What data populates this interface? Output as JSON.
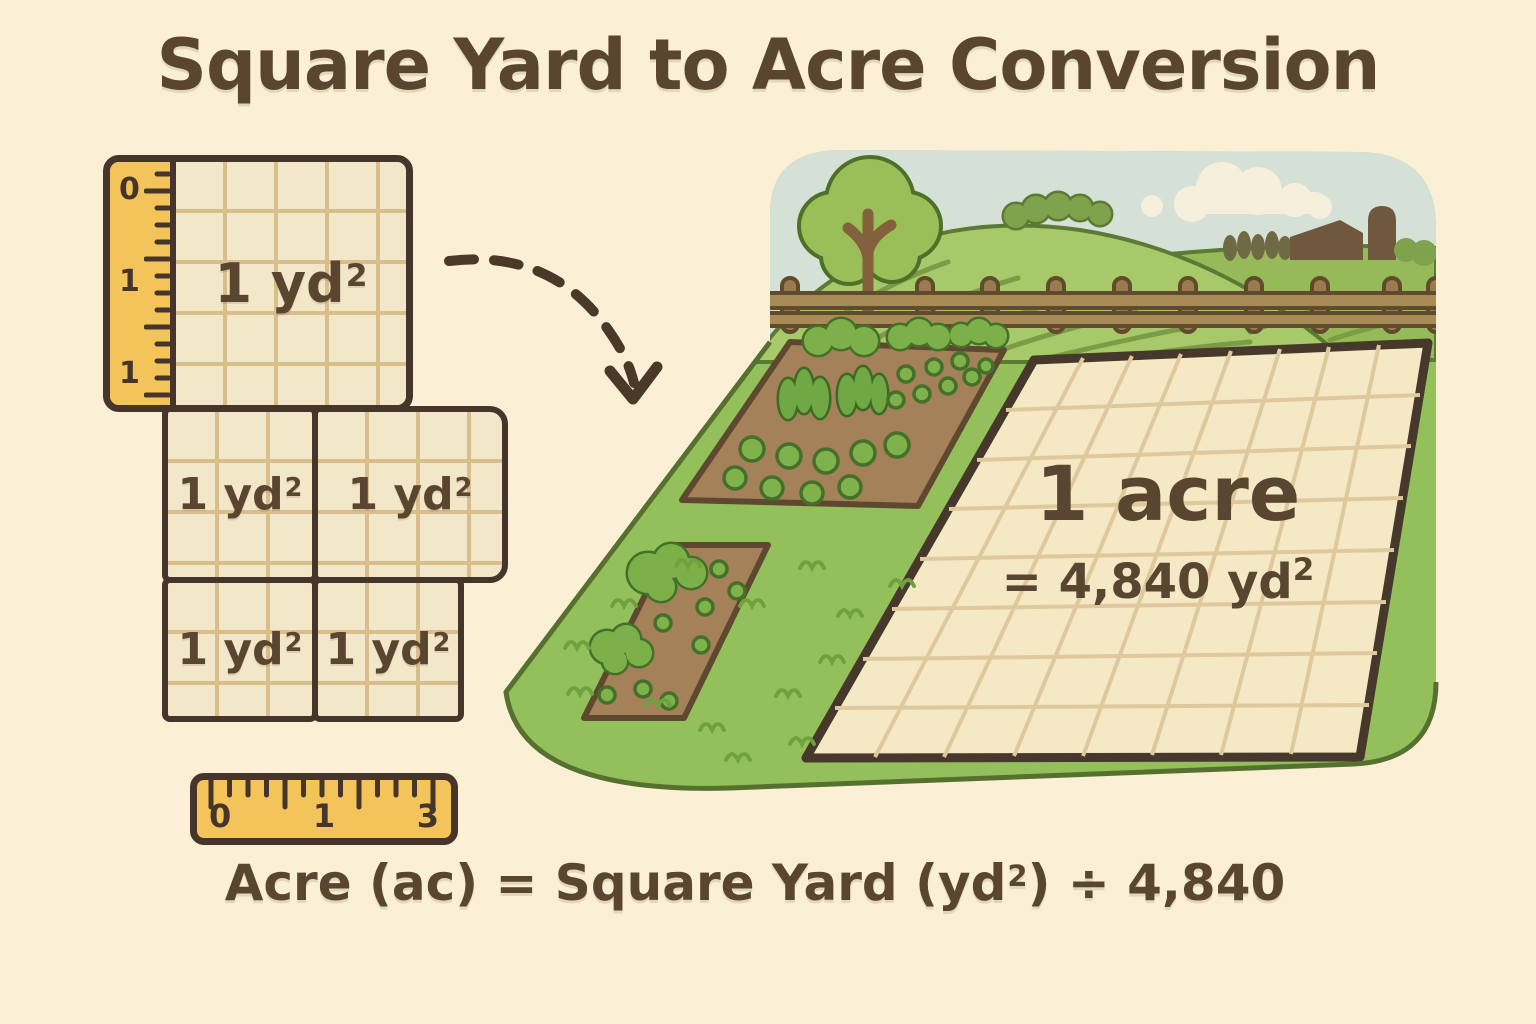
{
  "title": "Square Yard to Acre Conversion",
  "left_diagram": {
    "vertical_ruler": {
      "tick_labels": [
        "0",
        "1",
        "1"
      ]
    },
    "unit_squares": [
      {
        "base": "1 yd",
        "sup": "2"
      },
      {
        "base": "1 yd",
        "sup": "2"
      },
      {
        "base": "1 yd",
        "sup": "2"
      },
      {
        "base": "1 yd",
        "sup": "2"
      },
      {
        "base": "1 yd",
        "sup": "2"
      }
    ]
  },
  "farm_scene": {
    "acre_parcel": {
      "label": "1 acre",
      "equation_base": "= 4,840 yd",
      "equation_sup": "2"
    }
  },
  "horizontal_ruler": {
    "tick_labels": [
      "0",
      "1",
      "3"
    ]
  },
  "formula": {
    "before_sup": "Acre (ac) = Square Yard (yd",
    "sup": "2",
    "after_sup": ") ÷ 4,840"
  },
  "colors": {
    "background": "#FBF0D5",
    "ink_brown": "#594530",
    "outline_brown": "#46352A",
    "ruler_yellow": "#F3C45A",
    "grid_fill": "#F2E7C8",
    "grid_line": "#D9BE8C",
    "grass_green": "#93C05A",
    "hill_green": "#A8C96A",
    "soil_brown": "#A5815A",
    "sky_blue": "#D5E1D6",
    "parcel_tan": "#F4E8C5"
  }
}
